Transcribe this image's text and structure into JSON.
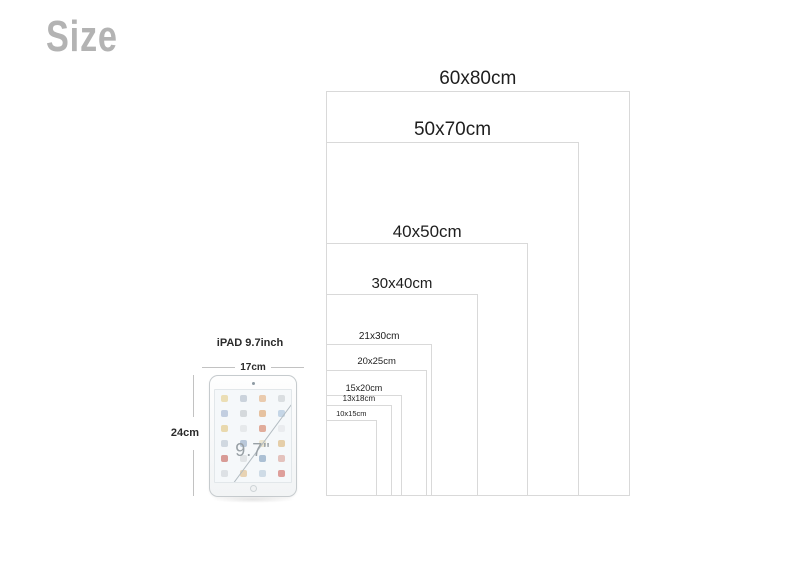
{
  "title": "Size",
  "chart_data": {
    "type": "size-comparison",
    "unit": "cm",
    "sizes": [
      {
        "label": "60x80cm",
        "w": 60,
        "h": 80
      },
      {
        "label": "50x70cm",
        "w": 50,
        "h": 70
      },
      {
        "label": "40x50cm",
        "w": 40,
        "h": 50
      },
      {
        "label": "30x40cm",
        "w": 30,
        "h": 40
      },
      {
        "label": "21x30cm",
        "w": 21,
        "h": 30
      },
      {
        "label": "20x25cm",
        "w": 20,
        "h": 25
      },
      {
        "label": "15x20cm",
        "w": 15,
        "h": 20
      },
      {
        "label": "13x18cm",
        "w": 13,
        "h": 18
      },
      {
        "label": "10x15cm",
        "w": 10,
        "h": 15
      }
    ],
    "reference_object": {
      "name_label": "iPAD 9.7inch",
      "width_label": "17cm",
      "height_label": "24cm",
      "screen_label": "9.7\""
    }
  },
  "ipad": {
    "name_label": "iPAD 9.7inch",
    "width_label": "17cm",
    "height_label": "24cm",
    "screen_label": "9.7\"",
    "icon_colors": [
      "#e9d9a8",
      "#c3cdd6",
      "#e8c3a0",
      "#d5d9dc",
      "#b9c7db",
      "#cfd4d6",
      "#e3b98f",
      "#bcd0e3",
      "#e6d3a0",
      "#e3e6e8",
      "#dd9f8a",
      "#e8eaec",
      "#c9d2da",
      "#aebfd4",
      "#e8e0c8",
      "#e2c79a",
      "#d28b84",
      "#dde0e2",
      "#9fb6cc",
      "#e0b9b2",
      "#d8dde0",
      "#e5cda6",
      "#c7d6e2",
      "#d98f89"
    ]
  },
  "colors": {
    "rect_border": "#d9d9d9",
    "title_gray": "#b3b3b3",
    "label_dark": "#1e1e1e"
  }
}
